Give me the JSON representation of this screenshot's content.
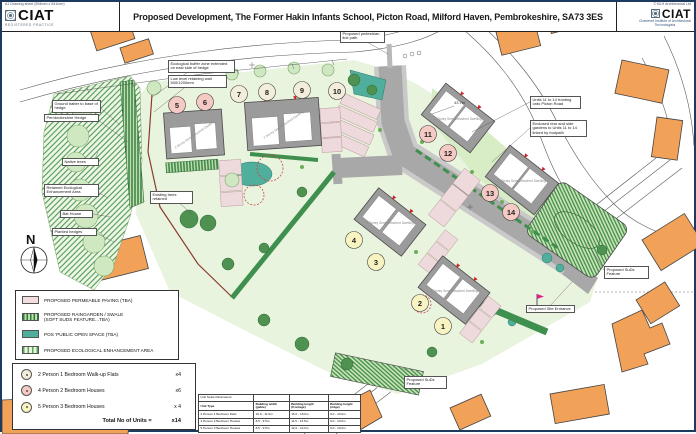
{
  "header": {
    "sheet_note": "A1 Drawing sheet (594mm x 841mm)",
    "copyright": "© BLH Architectural Ltd",
    "title": "Proposed Development, The Former Hakin Infants School, Picton Road, Milford Haven, Pembrokeshire, SA73 3ES",
    "logo": {
      "name": "CIAT",
      "name_right": "CIAT",
      "left_sub": "REGISTERED PRACTICE",
      "right_sub": "Chartered Institute of Architectural Technologists"
    }
  },
  "plan": {
    "north_label": "N",
    "dimension": "43.7m",
    "building_label": "2 Storey Semi Detached Dwelling",
    "plots": [
      {
        "number": "1",
        "type": "house3"
      },
      {
        "number": "2",
        "type": "house3"
      },
      {
        "number": "3",
        "type": "house3"
      },
      {
        "number": "4",
        "type": "house3"
      },
      {
        "number": "5",
        "type": "house2"
      },
      {
        "number": "6",
        "type": "house2"
      },
      {
        "number": "7",
        "type": "flat"
      },
      {
        "number": "8",
        "type": "flat"
      },
      {
        "number": "9",
        "type": "flat"
      },
      {
        "number": "10",
        "type": "flat"
      },
      {
        "number": "11",
        "type": "house2"
      },
      {
        "number": "12",
        "type": "house2"
      },
      {
        "number": "13",
        "type": "house2"
      },
      {
        "number": "14",
        "type": "house2"
      }
    ],
    "colors": {
      "existing_building_orange": "#f2a159",
      "road_grey": "#a8a8a8",
      "plot_green": "#e9f4df",
      "pos_teal": "#4fae9c",
      "paving_pink": "#eedadd",
      "hedge_green": "#2e7a3e",
      "circle_pink": "#f5c9c4",
      "circle_yellow": "#f8f3c0",
      "circle_cream": "#f3eedb"
    }
  },
  "annotations": [
    {
      "text": "Ecological buffer zone extended on east side of hedge"
    },
    {
      "text": "Low level retaining wall 500/1200mm"
    },
    {
      "text": "Ground batter to base of hedge"
    },
    {
      "text": "Pembrokeshire Hedge"
    },
    {
      "text": "Native trees"
    },
    {
      "text": "Retained Ecological Enhancement Area"
    },
    {
      "text": "Bat House"
    },
    {
      "text": "Planted hedges"
    },
    {
      "text": "Existing trees retained"
    },
    {
      "text": "Proposed pedestrian link path"
    },
    {
      "text": "Units 11 to 14 fronting onto Picton Road"
    },
    {
      "text": "Enclosed rear and side gardens to Units 11 to 14 linked by footpath"
    },
    {
      "text": "Proposed SuDs Feature"
    },
    {
      "text": "Proposed SuDs Feature"
    },
    {
      "text": "Proposed Site Entrance"
    }
  ],
  "legend": {
    "items": [
      {
        "label": "PROPOSED PERMEABLE PAVING (TBA)",
        "label2": ""
      },
      {
        "label": "PROPOSED RAINGARDEN / SWALE",
        "label2": "(SOFT SUDS FEATURE...TBA)"
      },
      {
        "label": "POS 'PUBLIC OPEN SPACE (TBA)",
        "label2": ""
      },
      {
        "label": "PROPOSED ECOLOGICAL ENHANCEMENT AREA",
        "label2": ""
      }
    ]
  },
  "schedule": {
    "rows": [
      {
        "label": "2 Person 1 Bedroom Walk-up Flats",
        "count": "x4"
      },
      {
        "label": "4 Person 2 Bedroom Houses",
        "count": "x6"
      },
      {
        "label": "5 Person 3 Bedroom Houses",
        "count": "x 4"
      }
    ],
    "total_label": "Total No of Units =",
    "total_count": "x14"
  },
  "table": {
    "caption": "Unit Scale Parameters:",
    "headers": [
      "Unit Type",
      "Building width (gable)",
      "Building length (frontage)",
      "Building height (ridge)"
    ],
    "rows": [
      [
        "2 Person 1 Bedroom Flats",
        "10.0 - 11.0m",
        "16.0 - 18.0m",
        "9.0 - 10.0m"
      ],
      [
        "4 Person 2 Bedroom Houses",
        "8.5 - 9.5m",
        "11.5 - 13.5m",
        "9.0 - 10.0m"
      ],
      [
        "5 Person 3 Bedroom Houses",
        "8.5 - 9.5m",
        "12.0 - 14.0m",
        "9.0 - 10.0m"
      ]
    ]
  }
}
